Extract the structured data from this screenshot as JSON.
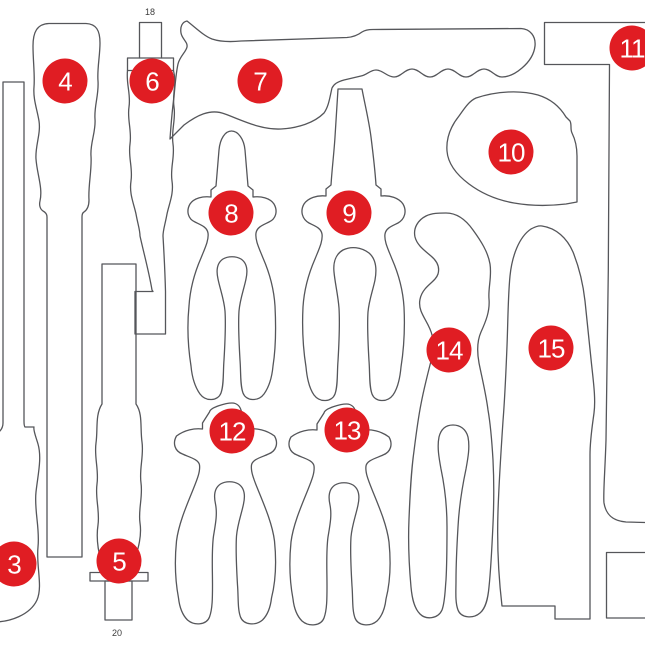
{
  "diagram": {
    "kind": "tool-foam-inlay-cutout-diagram",
    "colors": {
      "background": "#ffffff",
      "outline": "#55565a",
      "marker_fill": "#e01d23",
      "marker_text": "#ffffff",
      "dim_label_text": "#3c3c3c"
    },
    "markers": [
      {
        "label": "3",
        "x": 14,
        "y": 564
      },
      {
        "label": "4",
        "x": 65,
        "y": 81
      },
      {
        "label": "5",
        "x": 119,
        "y": 561
      },
      {
        "label": "6",
        "x": 152,
        "y": 81
      },
      {
        "label": "7",
        "x": 260,
        "y": 81
      },
      {
        "label": "8",
        "x": 231,
        "y": 213
      },
      {
        "label": "9",
        "x": 349,
        "y": 213
      },
      {
        "label": "10",
        "x": 511,
        "y": 152
      },
      {
        "label": "11",
        "x": 632,
        "y": 48
      },
      {
        "label": "12",
        "x": 232,
        "y": 431
      },
      {
        "label": "13",
        "x": 347,
        "y": 430
      },
      {
        "label": "14",
        "x": 449,
        "y": 350
      },
      {
        "label": "15",
        "x": 551,
        "y": 348
      }
    ],
    "dimension_labels": [
      {
        "label": "18",
        "x": 150,
        "y": 12
      },
      {
        "label": "20",
        "x": 117,
        "y": 633
      }
    ]
  }
}
